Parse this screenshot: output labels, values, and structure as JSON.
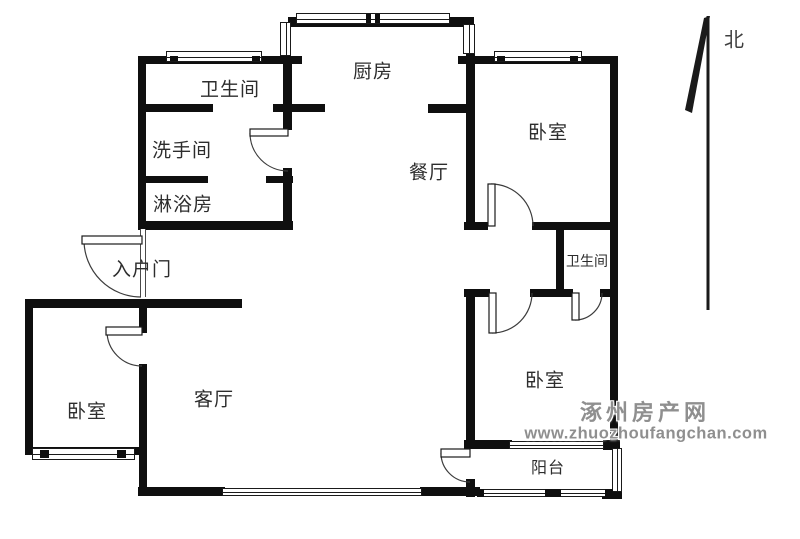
{
  "compass": {
    "label": "北"
  },
  "rooms": [
    {
      "id": "bathroom-top",
      "label": "卫生间"
    },
    {
      "id": "washroom",
      "label": "洗手间"
    },
    {
      "id": "shower-room",
      "label": "淋浴房"
    },
    {
      "id": "kitchen",
      "label": "厨房"
    },
    {
      "id": "dining-room",
      "label": "餐厅"
    },
    {
      "id": "bedroom-northeast",
      "label": "卧室"
    },
    {
      "id": "bathroom-ensuite",
      "label": "卫生间"
    },
    {
      "id": "entrance",
      "label": "入户门"
    },
    {
      "id": "bedroom-west",
      "label": "卧室"
    },
    {
      "id": "living-room",
      "label": "客厅"
    },
    {
      "id": "bedroom-southeast",
      "label": "卧室"
    },
    {
      "id": "balcony",
      "label": "阳台"
    }
  ],
  "watermark": {
    "site_name": "涿州房产网",
    "site_url": "www.zhuozhoufangchan.com",
    "color": "#8f8f8f"
  },
  "colors": {
    "wall": "#0f0f0f",
    "background": "#ffffff",
    "label_text": "#2d2d2d"
  }
}
